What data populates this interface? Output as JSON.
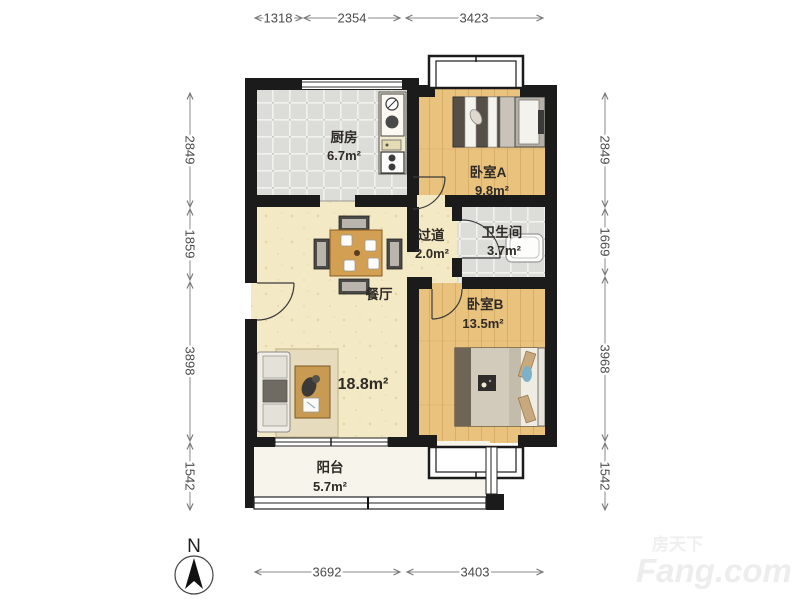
{
  "plan": {
    "type": "apartment-floor-plan",
    "units": "mm"
  },
  "dims": {
    "top": [
      "1318",
      "2354",
      "3423"
    ],
    "bottom": [
      "3692",
      "3403"
    ],
    "left": [
      "2849",
      "1859",
      "3898",
      "1542"
    ],
    "right": [
      "2849",
      "1669",
      "3968",
      "1542"
    ]
  },
  "rooms": {
    "kitchen": {
      "name": "厨房",
      "area": "6.7m²"
    },
    "bedroomA": {
      "name": "卧室A",
      "area": "9.8m²"
    },
    "hallway": {
      "name": "过道",
      "area": "2.0m²"
    },
    "bathroom": {
      "name": "卫生间",
      "area": "3.7m²"
    },
    "dining": {
      "name": "餐厅"
    },
    "living": {
      "area": "18.8m²"
    },
    "bedroomB": {
      "name": "卧室B",
      "area": "13.5m²"
    },
    "balcony": {
      "name": "阳台",
      "area": "5.7m²"
    }
  },
  "compass": {
    "label": "N"
  },
  "watermark": {
    "line1": "房天下",
    "line2": "Fang.com"
  },
  "colors": {
    "wall": "#1b1b1b",
    "wood_floor": "#e9c27d",
    "tile_floor": "#dcddd8",
    "living_floor": "#f4e9c5",
    "balcony_floor": "#f7f4ec",
    "dim_line": "#888888"
  }
}
